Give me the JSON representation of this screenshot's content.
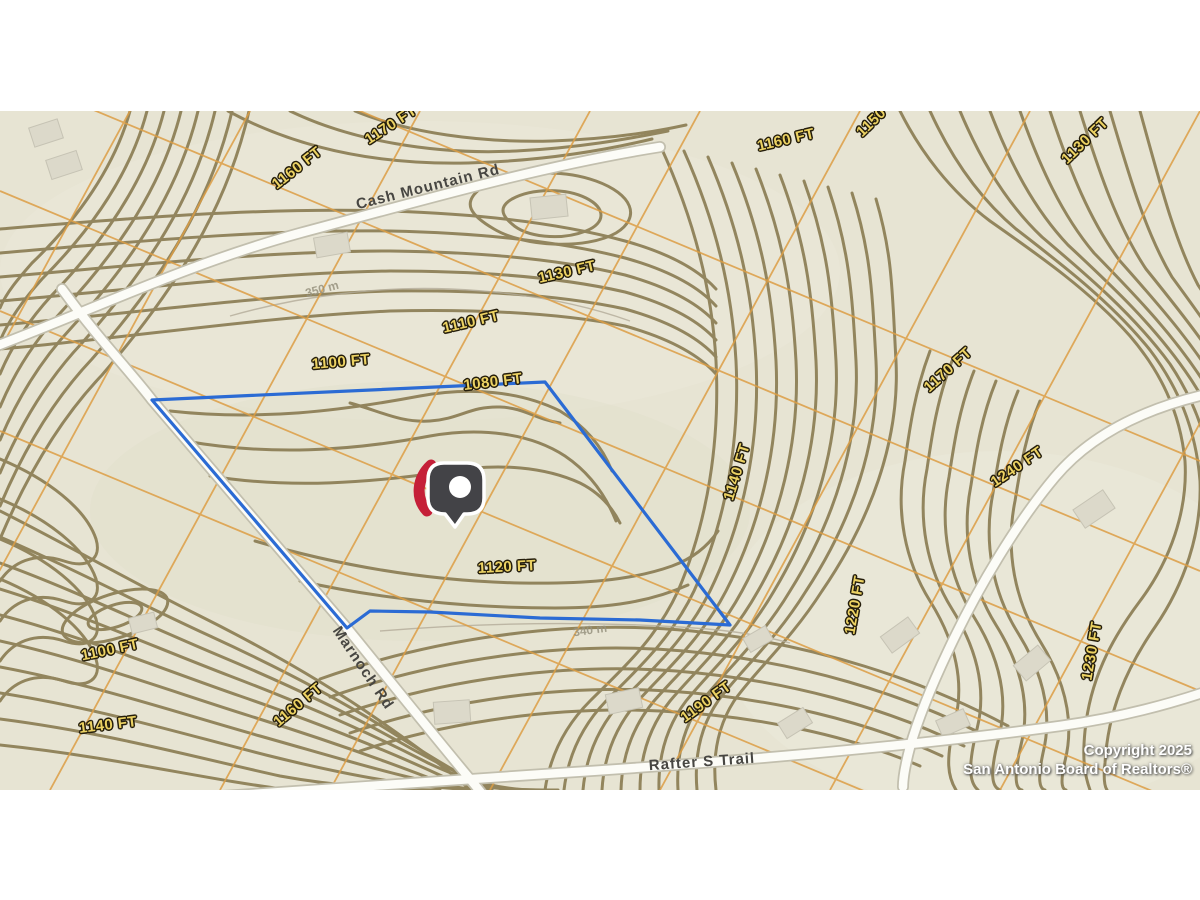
{
  "map": {
    "colors": {
      "background": "#e7e4d3",
      "contour": "#8b7d54",
      "parcel_line": "#dd9e45",
      "road_fill": "#fcfcf7",
      "road_casing": "#c2bfae",
      "boundary": "#2b6bd4",
      "elevation_text": "#ecd263",
      "pin_body": "#434347",
      "pin_accent": "#c51f38"
    },
    "boundary": {
      "points": "152,289 545,271 730,514 640,509 540,507 430,501 370,500 347,517"
    },
    "elevation_labels": [
      {
        "text": "1160 FT",
        "x": 297,
        "y": 57,
        "rot": -38
      },
      {
        "text": "1170 FT",
        "x": 391,
        "y": 14,
        "rot": -33
      },
      {
        "text": "1150 FT",
        "x": 880,
        "y": 3,
        "rot": -44
      },
      {
        "text": "1160 FT",
        "x": 786,
        "y": 29,
        "rot": -13
      },
      {
        "text": "1130 FT",
        "x": 1085,
        "y": 30,
        "rot": -44
      },
      {
        "text": "1130 FT",
        "x": 567,
        "y": 161,
        "rot": -13
      },
      {
        "text": "1110 FT",
        "x": 471,
        "y": 211,
        "rot": -13
      },
      {
        "text": "1100 FT",
        "x": 341,
        "y": 251,
        "rot": -5
      },
      {
        "text": "1080 FT",
        "x": 493,
        "y": 271,
        "rot": -7
      },
      {
        "text": "1170 FT",
        "x": 948,
        "y": 259,
        "rot": -42
      },
      {
        "text": "1140 FT",
        "x": 737,
        "y": 361,
        "rot": -73
      },
      {
        "text": "1240 FT",
        "x": 1017,
        "y": 356,
        "rot": -34
      },
      {
        "text": "1120 FT",
        "x": 507,
        "y": 456,
        "rot": -3
      },
      {
        "text": "1220 FT",
        "x": 855,
        "y": 494,
        "rot": -80
      },
      {
        "text": "1230 FT",
        "x": 1092,
        "y": 540,
        "rot": -80
      },
      {
        "text": "1190 FT",
        "x": 706,
        "y": 591,
        "rot": -36
      },
      {
        "text": "1100 FT",
        "x": 110,
        "y": 539,
        "rot": -12
      },
      {
        "text": "1160 FT",
        "x": 298,
        "y": 594,
        "rot": -40
      },
      {
        "text": "1140 FT",
        "x": 108,
        "y": 614,
        "rot": -7
      }
    ],
    "metric_labels": [
      {
        "text": "350 m",
        "x": 322,
        "y": 178,
        "rot": -15
      },
      {
        "text": "340 m",
        "x": 590,
        "y": 519,
        "rot": -8
      }
    ],
    "road_labels": [
      {
        "text": "Cash Mountain Rd",
        "x": 428,
        "y": 76,
        "rot": -14
      },
      {
        "text": "Marnoch Rd",
        "x": 363,
        "y": 557,
        "rot": 56
      },
      {
        "text": "Rafter S Trail",
        "x": 702,
        "y": 651,
        "rot": -4
      }
    ],
    "pin": {
      "x": 453,
      "y": 380
    },
    "copyright": {
      "line1": "Copyright 2025",
      "line2": "San Antonio Board of Realtors®"
    }
  }
}
